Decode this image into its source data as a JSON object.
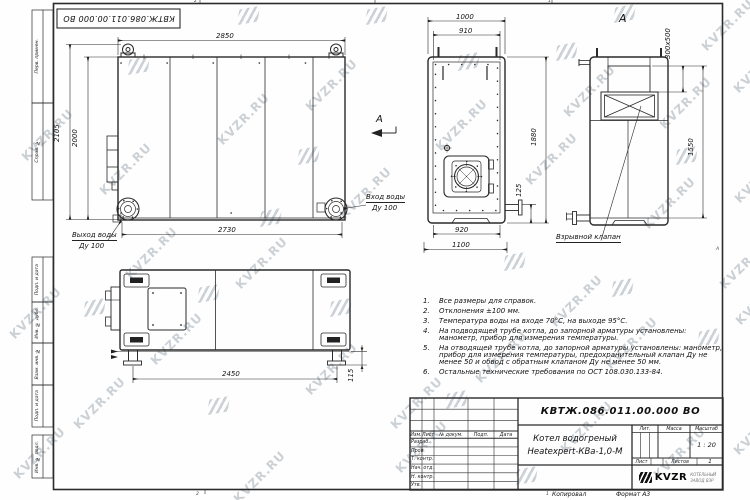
{
  "watermark": {
    "text": "KVZR.RU"
  },
  "frame": {
    "left_labels": [
      "Перв. примен.",
      "Справ. №",
      "Подп. и дата",
      "Инв. № дубл.",
      "Взам. инв. №",
      "Подп. и дата",
      "Инв. № подл."
    ],
    "stamp": "КВТЖ.086.011.00.000 ВО",
    "zone_marks": {
      "top_left": "2",
      "top_right": "1",
      "bottom_left": "2",
      "bottom_right": "1",
      "right": "А"
    }
  },
  "views": {
    "front": {
      "dims": {
        "width_top": "2850",
        "height_outer": "2105",
        "height_inner": "2000",
        "width_bottom": "2730"
      },
      "inlet_label_1": "Вход воды",
      "inlet_label_2": "Ду 100",
      "outlet_label_1": "Выход воды",
      "outlet_label_2": "Ду 100",
      "section_arrow": "А"
    },
    "end": {
      "dims": {
        "top_outer": "1000",
        "top_inner": "910",
        "height": "1880",
        "nozzle": "125",
        "bottom_inner": "920",
        "bottom_outer": "1100"
      }
    },
    "view_a": {
      "title": "А",
      "dims": {
        "chimney": "300х500",
        "height": "1550"
      },
      "valve_label": "Взрывной клапан"
    },
    "plan": {
      "dims": {
        "supports": "2450",
        "foot": "115"
      }
    }
  },
  "notes": {
    "items": [
      {
        "num": "1.",
        "text": "Все размеры для справок."
      },
      {
        "num": "2.",
        "text": "Отклонения ±100 мм."
      },
      {
        "num": "3.",
        "text": "Температура воды на входе 70°С, на выходе 95°С."
      },
      {
        "num": "4.",
        "text": "На подводящей трубе котла, до запорной арматуры установлены: манометр, прибор для измерения температуры."
      },
      {
        "num": "5.",
        "text": "На отводящей трубе котла, до запорной арматуры установлены: манометр, прибор для измерения температуры, предохранительный клапан Ду не менее 50 и обвод с обратным клапаном Ду не менее 50 мм."
      },
      {
        "num": "6.",
        "text": "Остальные технические требования по ОСТ 108.030.133-84."
      }
    ]
  },
  "title_block": {
    "doc_number": "КВТЖ.086.011.00.000 ВО",
    "product_name_1": "Котел водогреный",
    "product_name_2": "Heatexpert-КВа-1,0-М",
    "header": {
      "izm": "Изм.",
      "list": "Лист",
      "doc": "№ докум.",
      "podp": "Подп.",
      "data": "Дата"
    },
    "rows": [
      "Разраб.",
      "Пров.",
      "Т. контр.",
      "Нач. отд.",
      "Н. контр.",
      "Утв."
    ],
    "lit_label": "Лит.",
    "mass_label": "Масса",
    "scale_label": "Масштаб",
    "scale_value": "1 : 20",
    "sheet_label": "Лист",
    "sheets_label": "Листов",
    "sheets_value": "1",
    "logo_text": "KVZR",
    "logo_sub_1": "КОТЕЛЬНЫЙ",
    "logo_sub_2": "ЗАВОД ВЗР",
    "copied_label": "Копировал",
    "format_label": "Формат А3"
  }
}
